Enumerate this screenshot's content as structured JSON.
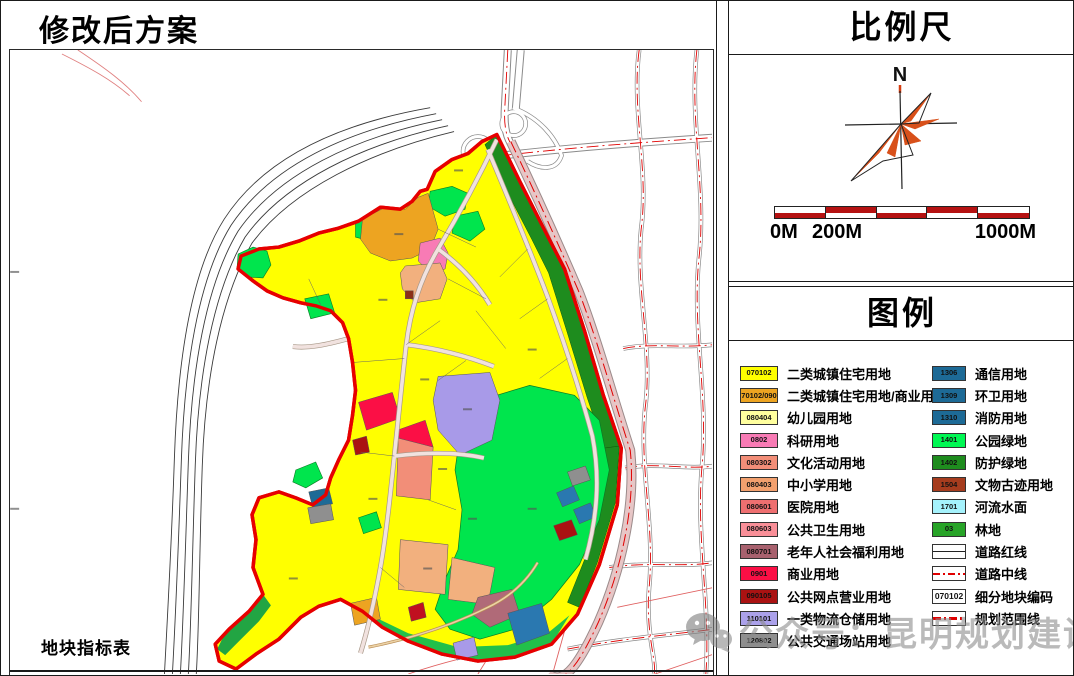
{
  "map_panel": {
    "title": "修改后方案",
    "table_caption": "地块指标表"
  },
  "scale_panel": {
    "title": "比例尺",
    "north_label": "N",
    "scale_start": "0M",
    "scale_mid": "200M",
    "scale_end": "1000M"
  },
  "legend_panel": {
    "title": "图例",
    "left_items": [
      {
        "code": "070102",
        "label": "二类城镇住宅用地",
        "color": "#ffff00"
      },
      {
        "code": "070102/0901",
        "label": "二类城镇住宅用地/商业用地",
        "color": "#eda421"
      },
      {
        "code": "080404",
        "label": "幼儿园用地",
        "color": "#ffff9e"
      },
      {
        "code": "0802",
        "label": "科研用地",
        "color": "#f87bb5"
      },
      {
        "code": "080302",
        "label": "文化活动用地",
        "color": "#f28e78"
      },
      {
        "code": "080403",
        "label": "中小学用地",
        "color": "#f2a06e"
      },
      {
        "code": "080601",
        "label": "医院用地",
        "color": "#ee6f70"
      },
      {
        "code": "080603",
        "label": "公共卫生用地",
        "color": "#f98f98"
      },
      {
        "code": "080701",
        "label": "老年人社会福利用地",
        "color": "#a8616e"
      },
      {
        "code": "0901",
        "label": "商业用地",
        "color": "#fb0f45"
      },
      {
        "code": "090105",
        "label": "公共网点营业用地",
        "color": "#aa1212"
      },
      {
        "code": "110101",
        "label": "一类物流仓储用地",
        "color": "#aba1ea"
      },
      {
        "code": "120802",
        "label": "公共交通场站用地",
        "color": "#8f8f8f"
      }
    ],
    "right_items": [
      {
        "code": "1306",
        "label": "通信用地",
        "color": "#1d6a96"
      },
      {
        "code": "1309",
        "label": "环卫用地",
        "color": "#1d6a96"
      },
      {
        "code": "1310",
        "label": "消防用地",
        "color": "#1d6a96"
      },
      {
        "code": "1401",
        "label": "公园绿地",
        "color": "#00f853"
      },
      {
        "code": "1402",
        "label": "防护绿地",
        "color": "#1e8c1e"
      },
      {
        "code": "1504",
        "label": "文物古迹用地",
        "color": "#a63c1e"
      },
      {
        "code": "1701",
        "label": "河流水面",
        "color": "#a5f2fc"
      },
      {
        "code": "03",
        "label": "林地",
        "color": "#28a428"
      },
      {
        "type": "road-red",
        "label": "道路红线"
      },
      {
        "type": "road-center",
        "label": "道路中线"
      },
      {
        "type": "code-box",
        "code": "070102",
        "label": "细分地块编码"
      },
      {
        "type": "boundary",
        "label": "规划范围线"
      }
    ]
  },
  "watermark": {
    "icon": "wechat-icon",
    "text": "公众号：昆明规划建设"
  },
  "colors": {
    "boundary_red": "#e60000",
    "road_center_red": "#e00000",
    "residential_yellow": "#ffff00",
    "park_green": "#00e54d",
    "protective_green": "#1e8c1e",
    "scalebar_red": "#b51212"
  }
}
